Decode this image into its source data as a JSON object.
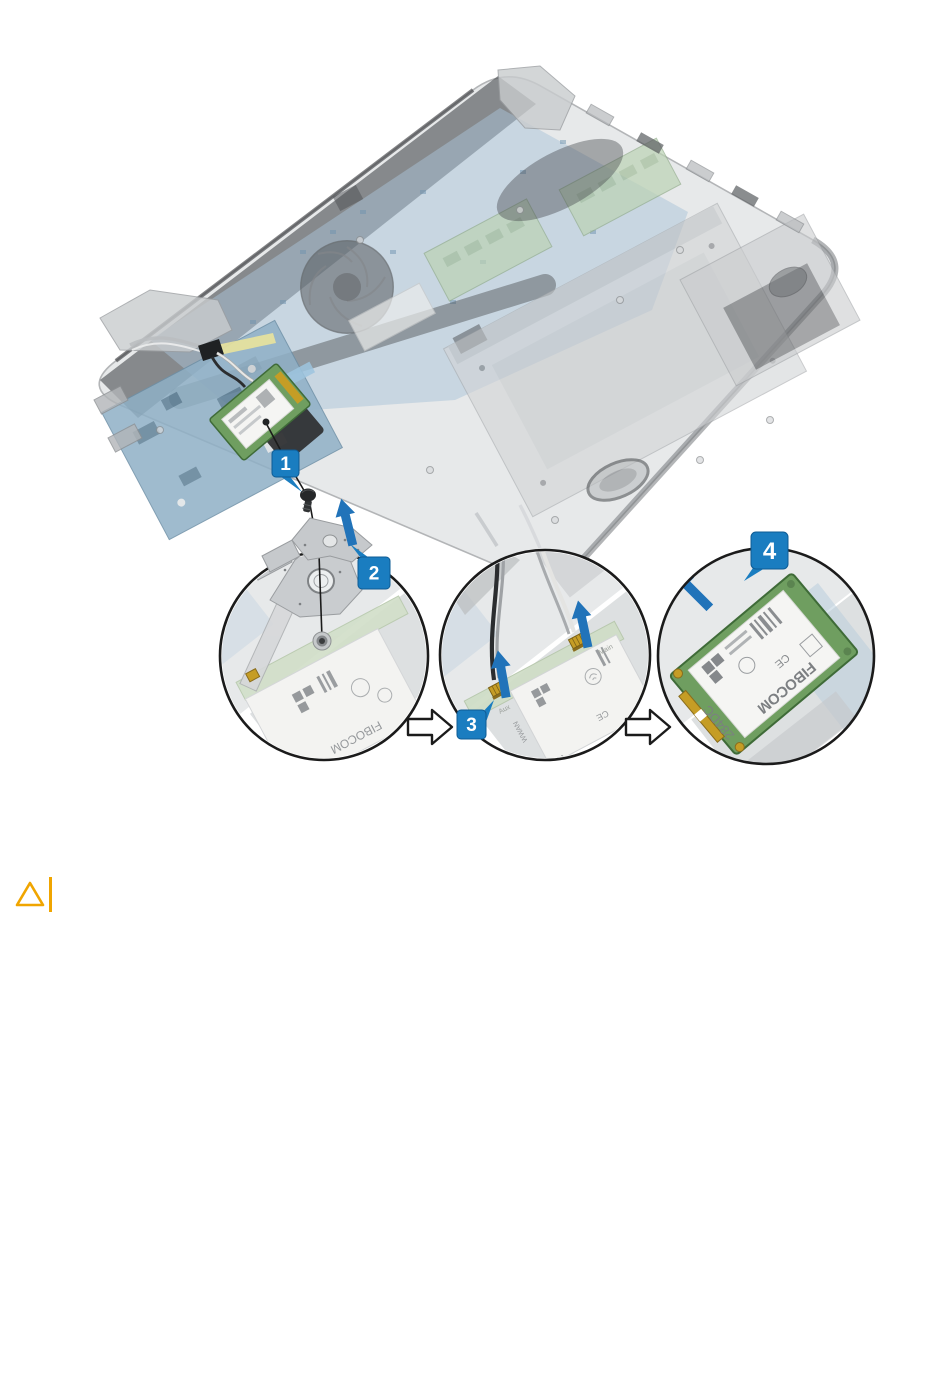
{
  "figure": {
    "callouts": {
      "one": "1",
      "two": "2",
      "three": "3",
      "four": "4"
    },
    "card": {
      "model": "284DC",
      "brand": "FIBOCOM",
      "ce": "CE",
      "slot": "WWAN",
      "antenna_main": "Main",
      "antenna_aux": "Aux"
    },
    "colors": {
      "callout_blue": "#1a7dc0",
      "callout_border": "#0f5c94",
      "arrow_blue": "#2173b9",
      "circle_outline": "#1b1b1b",
      "step_arrow_fill": "#ffffff",
      "pcb_green": "#6f9e60",
      "pcb_blue": "#8fb0c6",
      "gold": "#c59d25",
      "caution_amber": "#F0A500"
    }
  },
  "caution": {
    "icon_name": "caution-triangle-icon",
    "color": "#F0A500"
  }
}
